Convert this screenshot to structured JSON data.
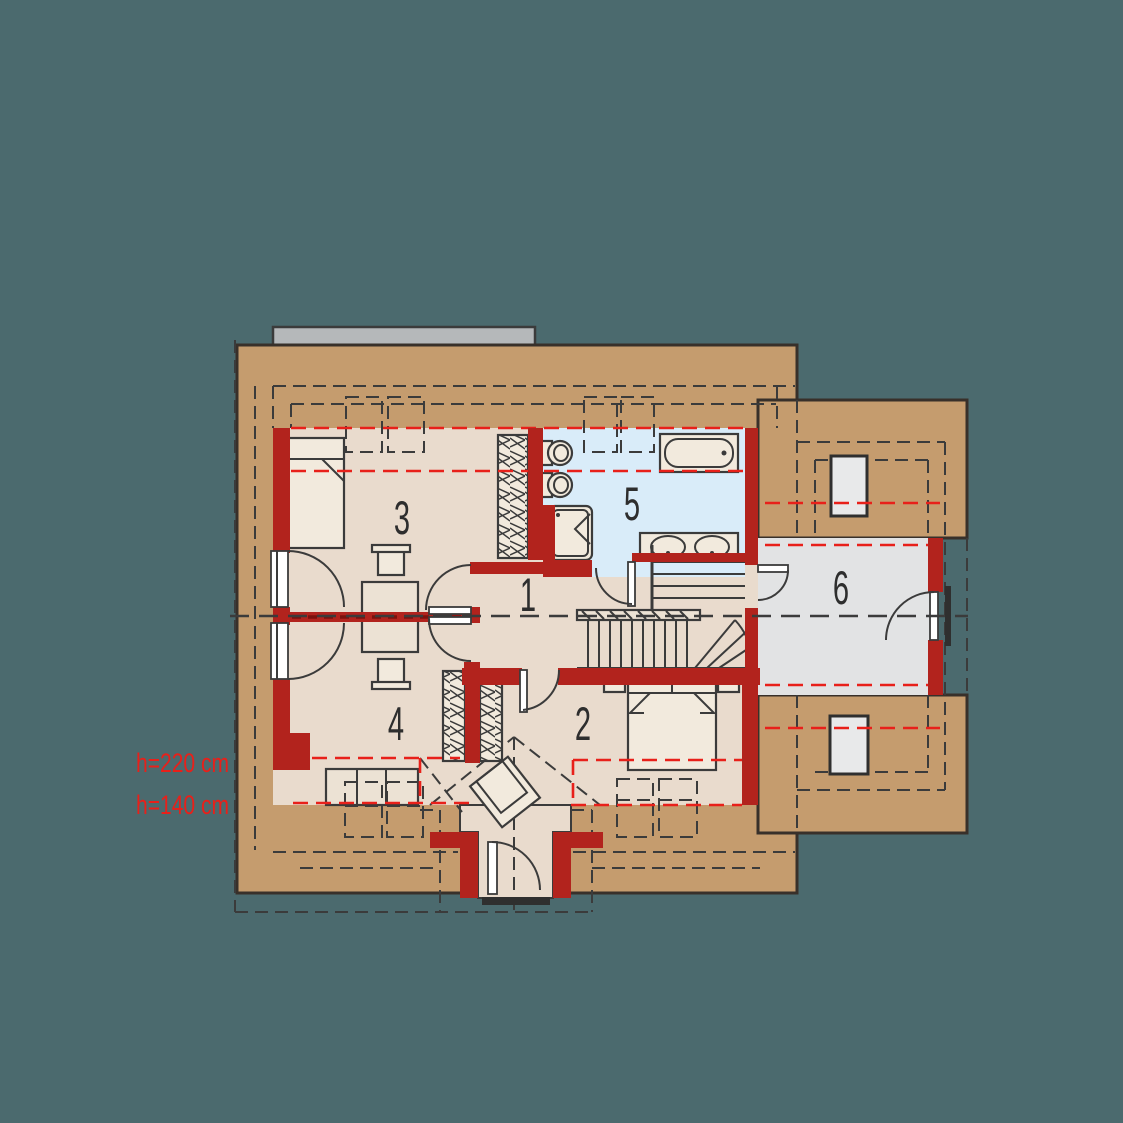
{
  "title": "Attic floor plan",
  "background_color": "#4b6a6e",
  "palette": {
    "roof_band": "#c59c6e",
    "wall_red": "#b2231d",
    "floor_beige": "#e9dbcd",
    "bathroom_blue": "#d9ecf9",
    "room6_gray": "#e2e3e4",
    "furniture_fill": "#f2eadd",
    "chimney_gray": "#b5b8ba",
    "red_dash": "#e8201a",
    "line_dark": "#3b3b3b"
  },
  "rooms": [
    {
      "id": 1,
      "label": "1"
    },
    {
      "id": 2,
      "label": "2"
    },
    {
      "id": 3,
      "label": "3"
    },
    {
      "id": 4,
      "label": "4"
    },
    {
      "id": 5,
      "label": "5"
    },
    {
      "id": 6,
      "label": "6"
    }
  ],
  "height_labels": {
    "h220": "h=220 cm",
    "h140": "h=140 cm"
  }
}
